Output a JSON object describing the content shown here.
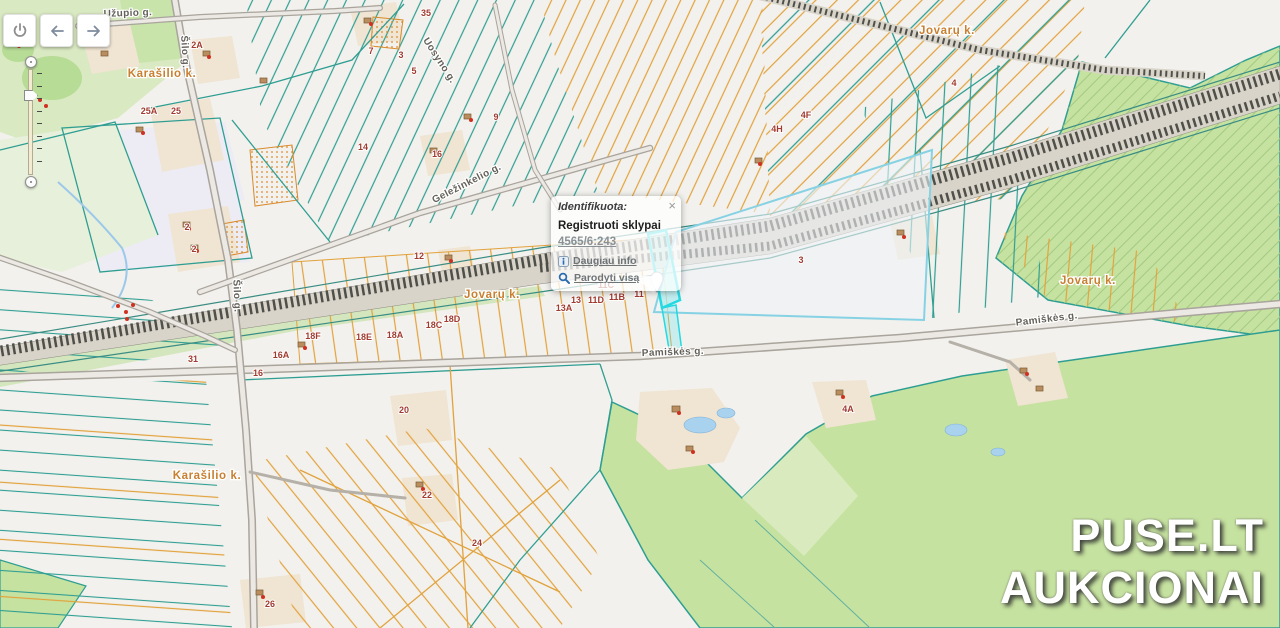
{
  "toolbar": {
    "buttons": [
      {
        "name": "power"
      },
      {
        "name": "back"
      },
      {
        "name": "forward"
      }
    ]
  },
  "zoom_slider": {
    "tick_count": 8
  },
  "popup": {
    "title": "Identifikuota:",
    "close_label": "×",
    "layer_name": "Registruoti sklypai",
    "parcel_id": "4565/6:243",
    "links": {
      "more_info": "Daugiau info",
      "show_all": "Parodyti visą"
    }
  },
  "watermark": {
    "line1": "PUSE.LT",
    "line2": "AUKCIONAI"
  },
  "map": {
    "villages": [
      {
        "text": "Karašilio k.",
        "x": 162,
        "y": 77
      },
      {
        "text": "Jovarų k.",
        "x": 947,
        "y": 34
      },
      {
        "text": "Jovarų k.",
        "x": 492,
        "y": 298
      },
      {
        "text": "Jovarų k.",
        "x": 1088,
        "y": 284
      },
      {
        "text": "Karašilio k.",
        "x": 207,
        "y": 479
      }
    ],
    "streets": [
      {
        "text": "Užupio g.",
        "x": 128,
        "y": 16,
        "angle": -2
      },
      {
        "text": "Šilo g.",
        "x": 182,
        "y": 52,
        "angle": 87
      },
      {
        "text": "Šilo g.",
        "x": 234,
        "y": 296,
        "angle": 88
      },
      {
        "text": "Geležinkelio g.",
        "x": 468,
        "y": 186,
        "angle": -27
      },
      {
        "text": "Uosyno g.",
        "x": 437,
        "y": 62,
        "angle": 57
      },
      {
        "text": "Pamiškės g.",
        "x": 673,
        "y": 355,
        "angle": -2
      },
      {
        "text": "Pamiškės g.",
        "x": 1047,
        "y": 322,
        "angle": -7
      }
    ],
    "parcel_numbers": [
      {
        "text": "2A",
        "x": 197,
        "y": 48
      },
      {
        "text": "25A",
        "x": 149,
        "y": 114
      },
      {
        "text": "25",
        "x": 176,
        "y": 114
      },
      {
        "text": "35",
        "x": 426,
        "y": 16
      },
      {
        "text": "7",
        "x": 371,
        "y": 54
      },
      {
        "text": "3",
        "x": 401,
        "y": 58
      },
      {
        "text": "5",
        "x": 414,
        "y": 74
      },
      {
        "text": "9",
        "x": 496,
        "y": 120
      },
      {
        "text": "14",
        "x": 363,
        "y": 150
      },
      {
        "text": "16",
        "x": 437,
        "y": 157
      },
      {
        "text": "12",
        "x": 419,
        "y": 259
      },
      {
        "text": "2",
        "x": 187,
        "y": 230
      },
      {
        "text": "2",
        "x": 194,
        "y": 252
      },
      {
        "text": "4H",
        "x": 777,
        "y": 132
      },
      {
        "text": "4F",
        "x": 806,
        "y": 118
      },
      {
        "text": "4",
        "x": 954,
        "y": 86
      },
      {
        "text": "3",
        "x": 801,
        "y": 263
      },
      {
        "text": "11C",
        "x": 606,
        "y": 288
      },
      {
        "text": "13",
        "x": 576,
        "y": 303
      },
      {
        "text": "11D",
        "x": 596,
        "y": 303
      },
      {
        "text": "11B",
        "x": 617,
        "y": 300
      },
      {
        "text": "11",
        "x": 639,
        "y": 297
      },
      {
        "text": "13A",
        "x": 564,
        "y": 311
      },
      {
        "text": "18D",
        "x": 452,
        "y": 322
      },
      {
        "text": "18C",
        "x": 434,
        "y": 328
      },
      {
        "text": "18A",
        "x": 395,
        "y": 338
      },
      {
        "text": "18E",
        "x": 364,
        "y": 340
      },
      {
        "text": "18F",
        "x": 313,
        "y": 339
      },
      {
        "text": "16A",
        "x": 281,
        "y": 358
      },
      {
        "text": "31",
        "x": 193,
        "y": 362
      },
      {
        "text": "16",
        "x": 258,
        "y": 376
      },
      {
        "text": "20",
        "x": 404,
        "y": 413
      },
      {
        "text": "4A",
        "x": 848,
        "y": 412
      },
      {
        "text": "22",
        "x": 427,
        "y": 498
      },
      {
        "text": "24",
        "x": 477,
        "y": 546
      },
      {
        "text": "26",
        "x": 270,
        "y": 607
      }
    ]
  },
  "colors": {
    "parcel_orange": "#e2a23c",
    "parcel_teal": "#2f9e92",
    "forest_green": "#c6e2a0",
    "highlight_cyan": "#24d9e0",
    "number_red": "#a03b30",
    "village_orange": "#c87f2f",
    "link_blue": "#2b6cb0"
  }
}
